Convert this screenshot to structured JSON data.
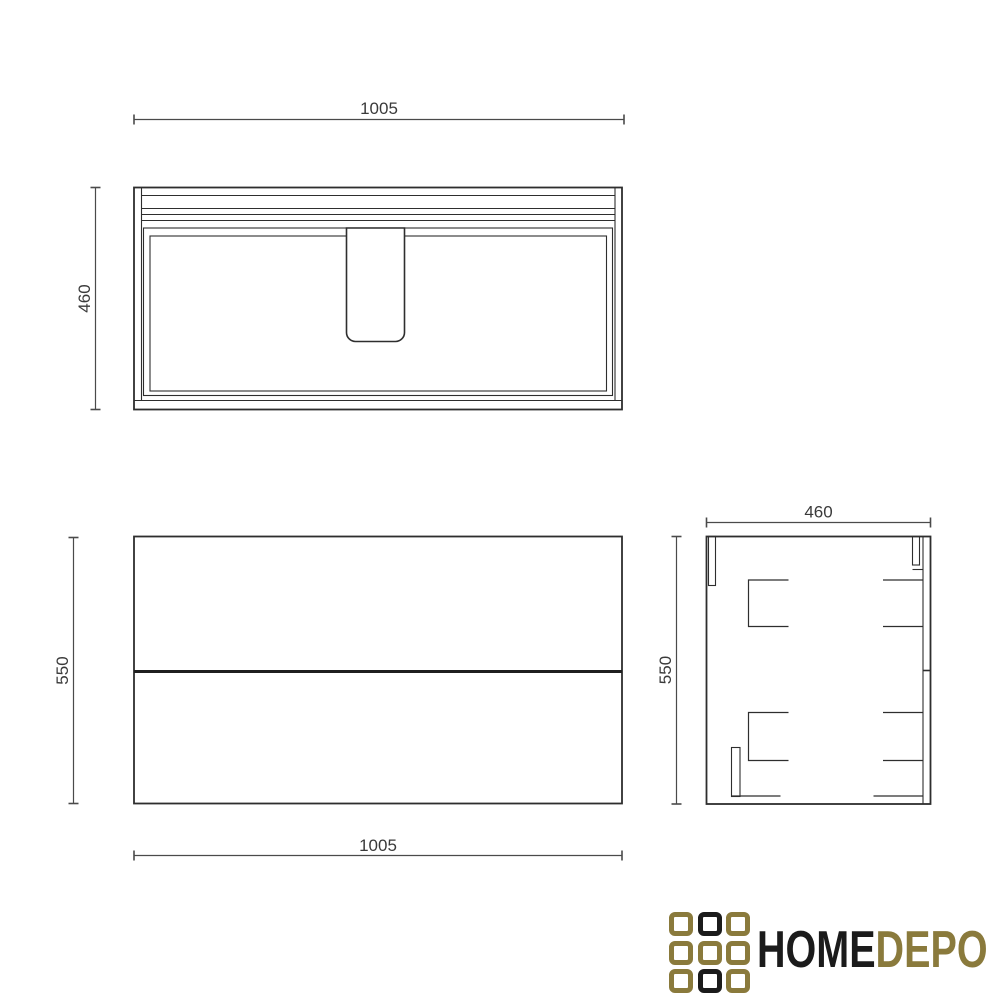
{
  "colors": {
    "line": "#2e2e2e",
    "dim_line": "#4a4a4a",
    "text": "#3a3a3a",
    "logo_black": "#1b1b1b",
    "logo_gold": "#8a7a3c",
    "background": "#ffffff"
  },
  "views": {
    "top": {
      "title": "top-view",
      "width_label": "1005",
      "depth_label": "460"
    },
    "front": {
      "title": "front-view",
      "width_label": "1005",
      "height_label": "550"
    },
    "side": {
      "title": "side-view",
      "width_label": "460",
      "height_label": "550"
    }
  },
  "logo": {
    "text_primary": "HOME",
    "text_secondary": "DEPO",
    "grid": [
      "gold",
      "black",
      "gold",
      "gold",
      "gold",
      "gold",
      "gold",
      "black",
      "gold"
    ]
  }
}
